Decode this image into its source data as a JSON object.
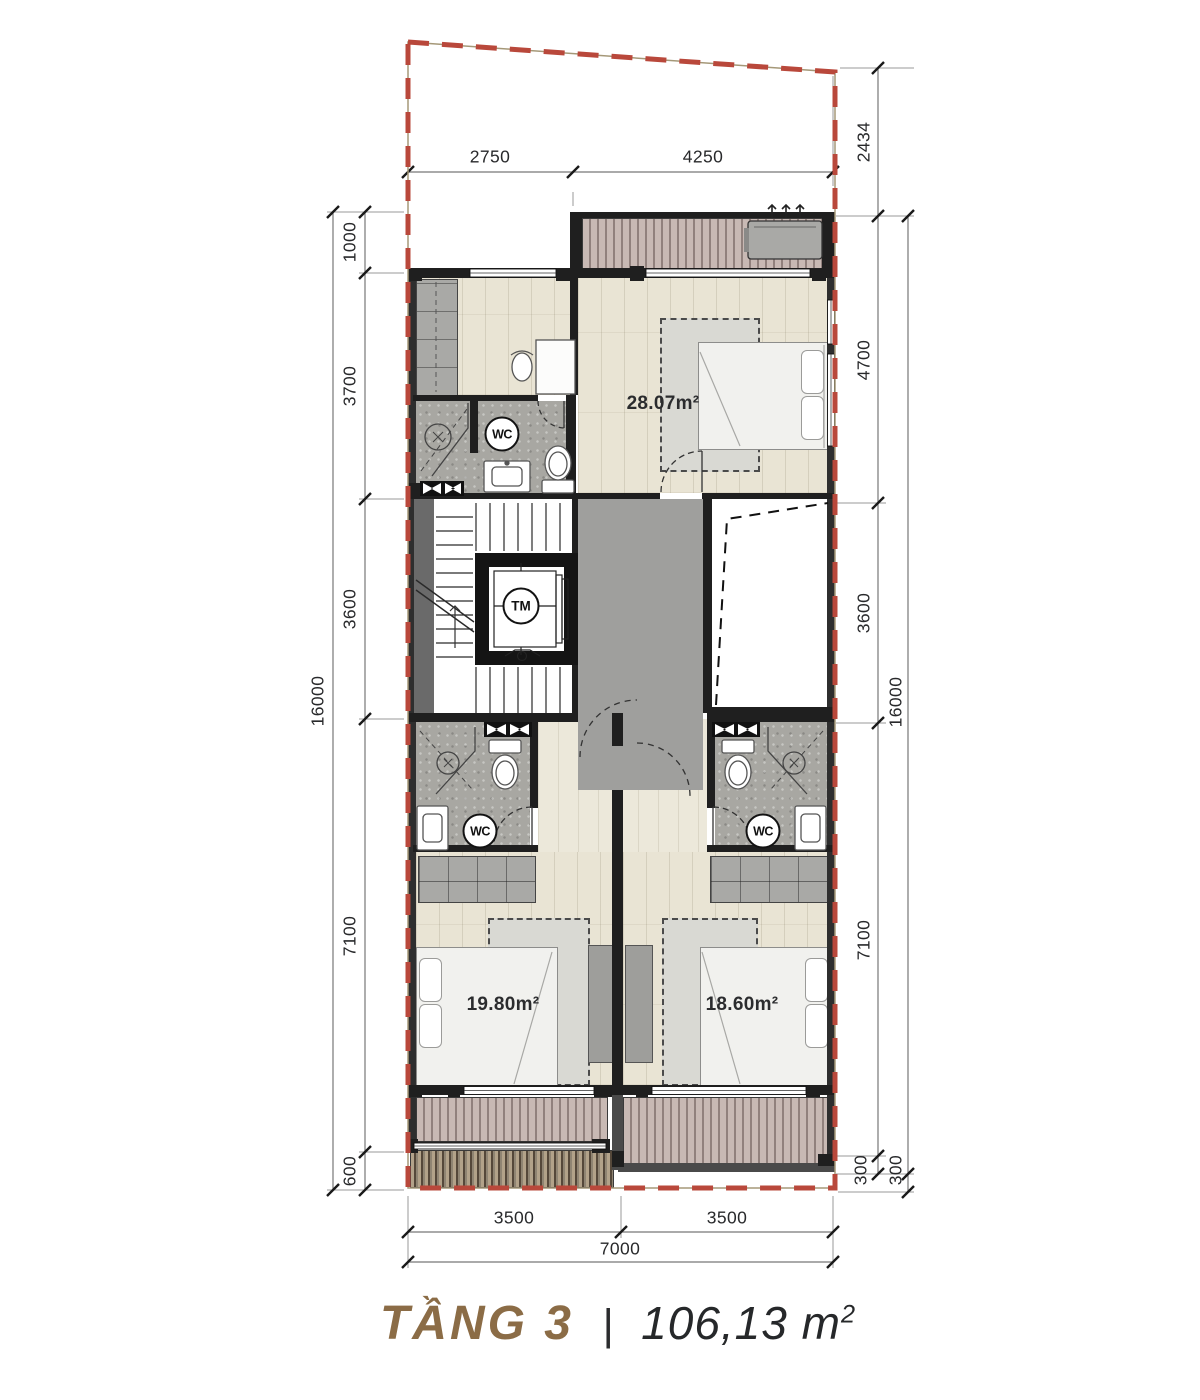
{
  "title": {
    "floor": "TẦNG 3",
    "separator": "|",
    "area_value": "106,13 m",
    "area_sup": "2"
  },
  "labels": {
    "wc": "WC",
    "elevator": "TM"
  },
  "rooms": {
    "master": "28.07m²",
    "bedroom_left": "19.80m²",
    "bedroom_right": "18.60m²"
  },
  "dimensions": {
    "top": [
      "2750",
      "4250"
    ],
    "right": [
      "2434",
      "4700",
      "3600",
      "7100",
      "300"
    ],
    "right_outer": [
      "16000",
      "300"
    ],
    "left": [
      "1000",
      "3700",
      "3600",
      "7100",
      "600"
    ],
    "left_outer": [
      "16000"
    ],
    "bottom": [
      "3500",
      "3500",
      "7000"
    ]
  },
  "colors": {
    "boundary": "#b9483b",
    "accent": "#8b6c46",
    "wall": "#1f1f1f",
    "wood": "#e9e4d4",
    "deck": "#c8b9b4",
    "tile": "#a8a7a2"
  }
}
